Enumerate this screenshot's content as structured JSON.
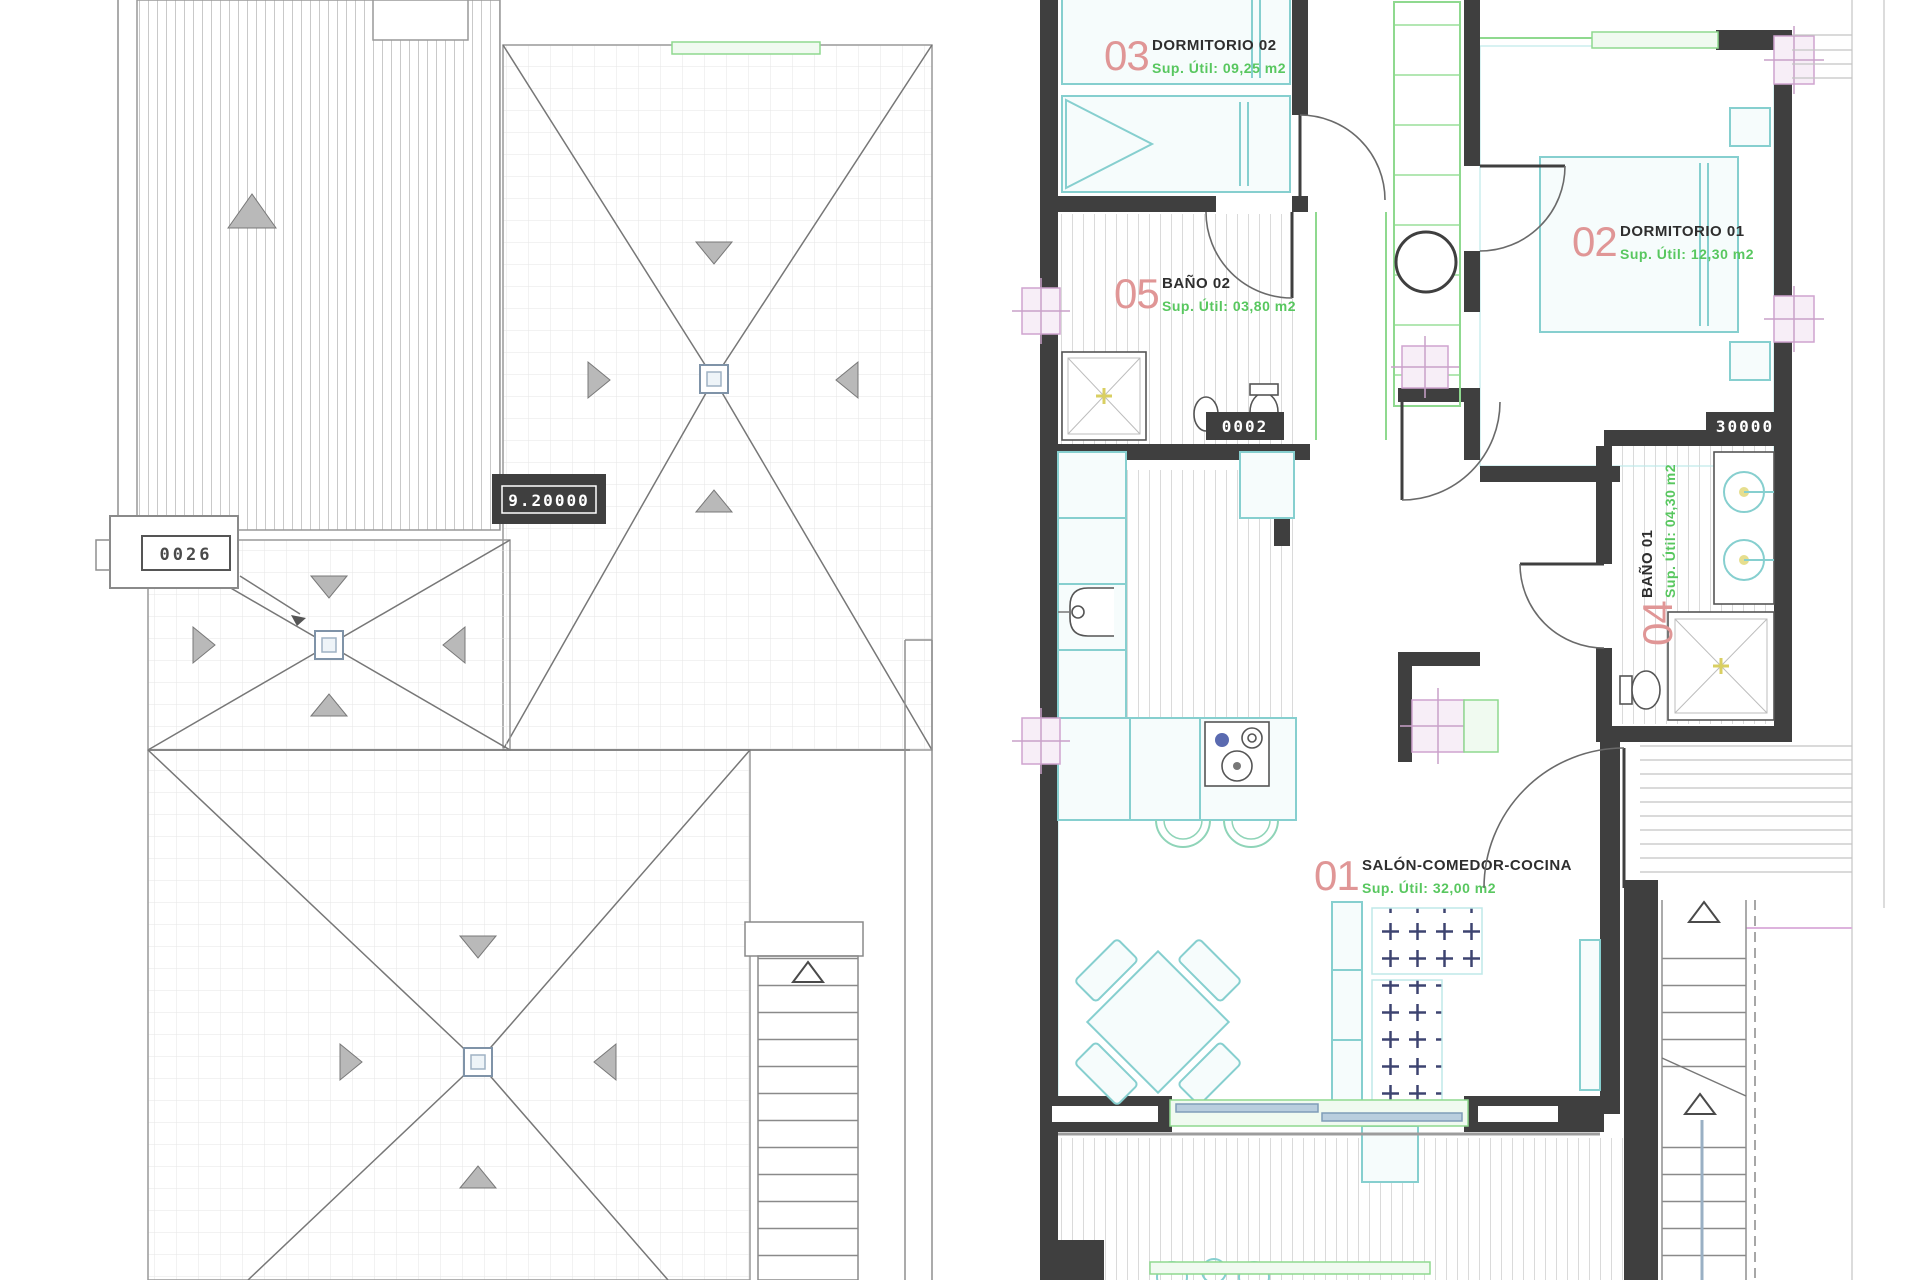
{
  "plan": {
    "rooms": [
      {
        "num": "01",
        "name": "SALÓN-COMEDOR-COCINA",
        "area": "Sup. Útil: 32,00 m2"
      },
      {
        "num": "02",
        "name": "DORMITORIO 01",
        "area": "Sup. Útil: 12,30 m2"
      },
      {
        "num": "03",
        "name": "DORMITORIO 02",
        "area": "Sup. Útil: 09,25 m2"
      },
      {
        "num": "04",
        "name": "BAÑO 01",
        "area": "Sup. Útil: 04,30 m2"
      },
      {
        "num": "05",
        "name": "BAÑO 02",
        "area": "Sup. Útil: 03,80 m2"
      }
    ],
    "tags": {
      "roof_plate": "9.20000",
      "roof_ref": "0026",
      "bath2_window": "0002",
      "bath1_window": "30000"
    },
    "colors": {
      "wall": "#3f3f3f",
      "room_number": "#e09696",
      "area_text": "#58c75f",
      "furniture": "#86cfcf",
      "window": "#8fd98f",
      "fixture_marker": "#cfa3cf",
      "glass": "#b9cede",
      "rug": "#3d4470"
    }
  }
}
